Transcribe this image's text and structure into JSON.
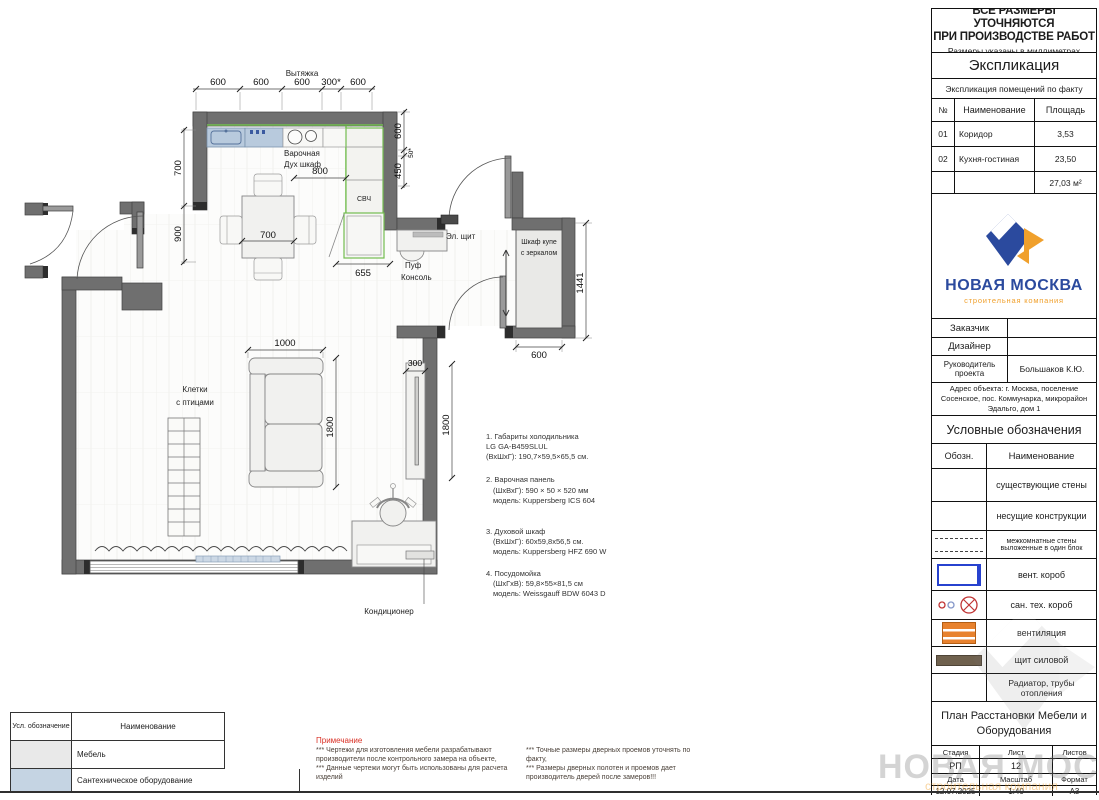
{
  "header_note": {
    "line1": "ВСЕ РАЗМЕРЫ УТОЧНЯЮТСЯ",
    "line2": "ПРИ ПРОИЗВОДСТВЕ РАБОТ",
    "subtitle": "Размеры указаны в миллиметрах"
  },
  "explication": {
    "title": "Экспликация",
    "subtitle": "Экспликация помещений по факту",
    "col_num": "№",
    "col_name": "Наименование",
    "col_area": "Площадь",
    "rows": [
      {
        "num": "01",
        "name": "Коридор",
        "area": "3,53"
      },
      {
        "num": "02",
        "name": "Кухня-гостиная",
        "area": "23,50"
      }
    ],
    "total": "27,03 м²"
  },
  "logo": {
    "title": "НОВАЯ МОСКВА",
    "subtitle": "строительная компания",
    "blue": "#2b4a9e",
    "orange": "#f0a02c"
  },
  "stamp": {
    "customer_label": "Заказчик",
    "designer_label": "Дизайнер",
    "manager_label": "Руководитель проекта",
    "manager_value": "Большаков К.Ю.",
    "address_line1": "Адрес объекта: г. Москва, поселение",
    "address_line2": "Сосенское, пос. Коммунарка, микрорайон",
    "address_line3": "Эдальго, дом 1"
  },
  "legend": {
    "title": "Условные обозначения",
    "col_symbol": "Обозн.",
    "col_name": "Наименование",
    "rows": [
      {
        "name": "существующие стены"
      },
      {
        "name": "несущие конструкции"
      },
      {
        "name": "межкомнатные стены выложенные в один блок"
      },
      {
        "name": "вент. короб"
      },
      {
        "name": "сан. тех. короб"
      },
      {
        "name": "вентиляция"
      },
      {
        "name": "щит силовой"
      },
      {
        "name": "Радиатор, трубы отопления"
      }
    ],
    "vent_box_color": "#2742cf",
    "ventilation_color": "#e8822e",
    "power_panel_color": "#6f614e",
    "san_red": "#c03434",
    "san_blue": "#8496c8"
  },
  "title_block": {
    "doc_title_line1": "План Расстановки Мебели и",
    "doc_title_line2": "Оборудования",
    "stage_label": "Стадия",
    "stage": "РП",
    "sheet_label": "Лист",
    "sheet": "12",
    "sheets_label": "Листов",
    "sheets": "",
    "date_label": "Дата",
    "date": "12.07.2025",
    "scale_label": "Масштаб",
    "scale": "1:40",
    "format_label": "Формат",
    "format": "А3"
  },
  "equipment_notes": [
    {
      "l1": "1. Габариты холодильника",
      "l2": "LG GA-B459SLUL",
      "l3": "(ВхШхГ): 190,7×59,5×65,5 см."
    },
    {
      "l1": "2. Варочная панель",
      "l2": "(ШхВхГ): 590 × 50 × 520 мм",
      "l3": "модель: Kuppersberg ICS 604"
    },
    {
      "l1": "3. Духовой шкаф",
      "l2": "(ВхШхГ): 60х59,8х56,5 см.",
      "l3": "модель: Kuppersberg HFZ 690 W"
    },
    {
      "l1": "4. Посудомойка",
      "l2": "(ШхГхВ): 59,8×55×81,5 см",
      "l3": "модель: Weissgauff BDW 6043 D"
    }
  ],
  "notes": {
    "title": "Примечание",
    "col1_p1": "*** Чертежи для изготовления мебели разрабатывают производители после контрольного замера на объекте,",
    "col1_p2": "***  Данные чертежи могут быть использованы для расчета изделий",
    "col2_p1": "*** Точные размеры дверных проемов уточнять по факту,",
    "col2_p2": "*** Размеры дверных полотен  и проемов дает производитель дверей после замеров!!!"
  },
  "furniture_table": {
    "col_symbol": "Усл. обозначение",
    "col_name": "Наименование",
    "rows": [
      {
        "name": "Мебель",
        "color": "#e9e9e9"
      },
      {
        "name": "Сантехническое оборудование",
        "color": "#c5d4e3"
      }
    ]
  },
  "plan": {
    "labels": {
      "hood": "Вытяжка",
      "hob": "Варочная",
      "oven": "Дух шкаф",
      "microwave": "СВЧ",
      "el_panel": "Эл. щит",
      "wardrobe1": "Шкаф купе",
      "wardrobe2": "с зеркалом",
      "pouf": "Пуф",
      "console": "Консоль",
      "cages1": "Клетки",
      "cages2": "с птицами",
      "ac": "Кондиционер"
    },
    "dims": {
      "top": [
        "600",
        "600",
        "600",
        "300*",
        "600"
      ],
      "right": [
        "600",
        "50*",
        "450"
      ],
      "left": [
        "700",
        "900"
      ],
      "hob_offset": "800",
      "fridge": "655",
      "table": "700",
      "sofa_w": "1000",
      "sofa_l": "1800",
      "tv_d": "300",
      "tv_l": "1800",
      "wardrobe_h": "1441",
      "wardrobe_w": "600"
    },
    "wall_color": "#6f6f6f",
    "cabinet_line_color": "#74bd51",
    "counter_blue": "#b8cadd",
    "radiator_blue": "#ccd8e5"
  },
  "watermark": {
    "text": "НОВАЯ МОСКВА",
    "subtext": "строительная компания"
  }
}
